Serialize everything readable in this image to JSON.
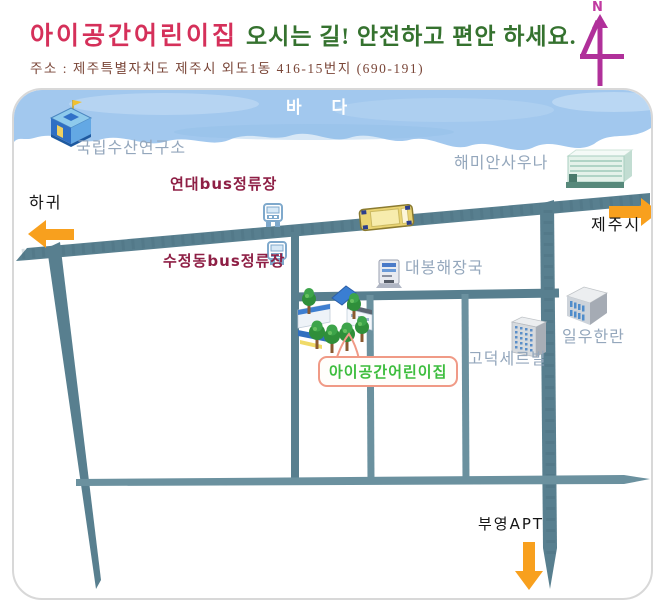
{
  "header": {
    "title": "아이공간어린이집",
    "subtitle": "오시는 길! 안전하고 편안 하세요.",
    "address": "주소 : 제주특별자치도 제주시 외도1동 416-15번지 (690-191)",
    "compass": "N"
  },
  "map": {
    "sea_label": "바 다",
    "labels": {
      "fisheries": "국립수산연구소",
      "sauna": "해미안사우나",
      "yeondae_bus": "연대bus정류장",
      "sujeong_bus": "수정동bus정류장",
      "hagwi": "하귀",
      "jeju_city": "제주시",
      "restaurant": "대봉해장국",
      "iluhanlan": "일우한란",
      "godeok": "고덕세르빌",
      "daycare": "아이공간어린이집",
      "buyeong_apt": "부영APT"
    },
    "icons": {
      "north_compass": "stylized-4-north-arrow",
      "fisheries_building": "blue-isometric-building-with-flag",
      "sauna_building": "mint-striped-building",
      "bus_stop": "blue-bus-front-glyph",
      "bus_on_road": "yellow-bus-top-view",
      "restaurant": "gray-machine-box",
      "daycare_buildings": "school-buildings-with-trees",
      "iluhanlan_building": "gray-cube-apartment",
      "godeok_building": "gray-highrise"
    },
    "colors": {
      "title_red": "#d5305a",
      "subtitle_green": "#35722f",
      "address_brown": "#7a4638",
      "sea_blue": "#a2c8ee",
      "road": "#587f8f",
      "road_thin": "#6b919f",
      "arrow_orange": "#f8a01e",
      "bus_label_red": "#8e1f45",
      "place_label_gray": "#94a7bc",
      "daycare_green": "#3dbd3d",
      "callout_salmon": "#f09a86",
      "compass_magenta": "#b0309a"
    }
  }
}
